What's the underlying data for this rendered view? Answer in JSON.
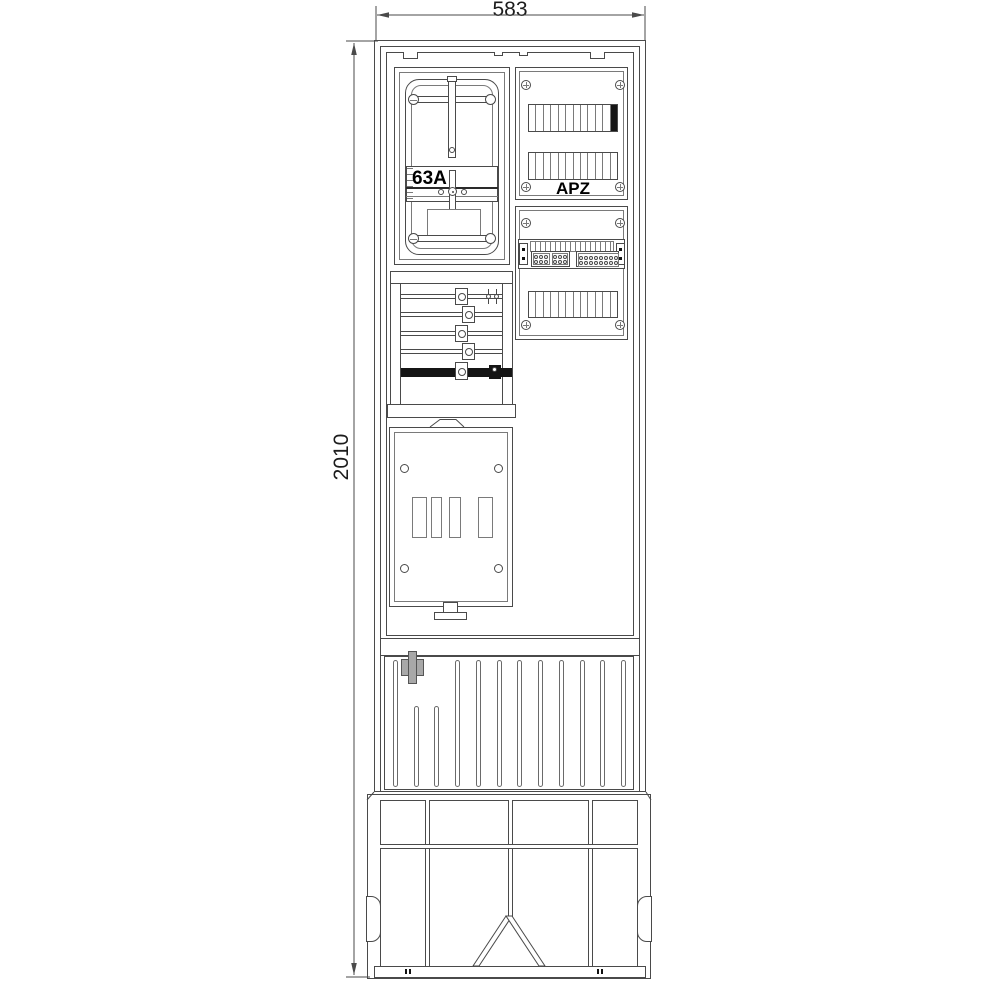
{
  "drawing": {
    "width_dim": "583",
    "height_dim": "2010"
  },
  "meter_panel": {
    "rating": "63A"
  },
  "apz_panel": {
    "label": "APZ",
    "rows": [
      {
        "modules": 12,
        "black_end": true
      },
      {
        "modules": 12,
        "black_end": false
      }
    ]
  },
  "terminal_panel": {
    "modules": 12,
    "pin_rows": 2,
    "left_pin_blocks": 2,
    "left_pin_cols": 3,
    "right_pin_cols": 8
  },
  "busbar_section": {
    "thin_bars": 4,
    "black_bars": 1
  },
  "plinth": {
    "ribs": 12,
    "short_rib_indexes": [
      1,
      2
    ]
  },
  "colors": {
    "line": "#4a4a4a",
    "black_fill": "#151515",
    "lock_gray": "#a8a8a8"
  }
}
